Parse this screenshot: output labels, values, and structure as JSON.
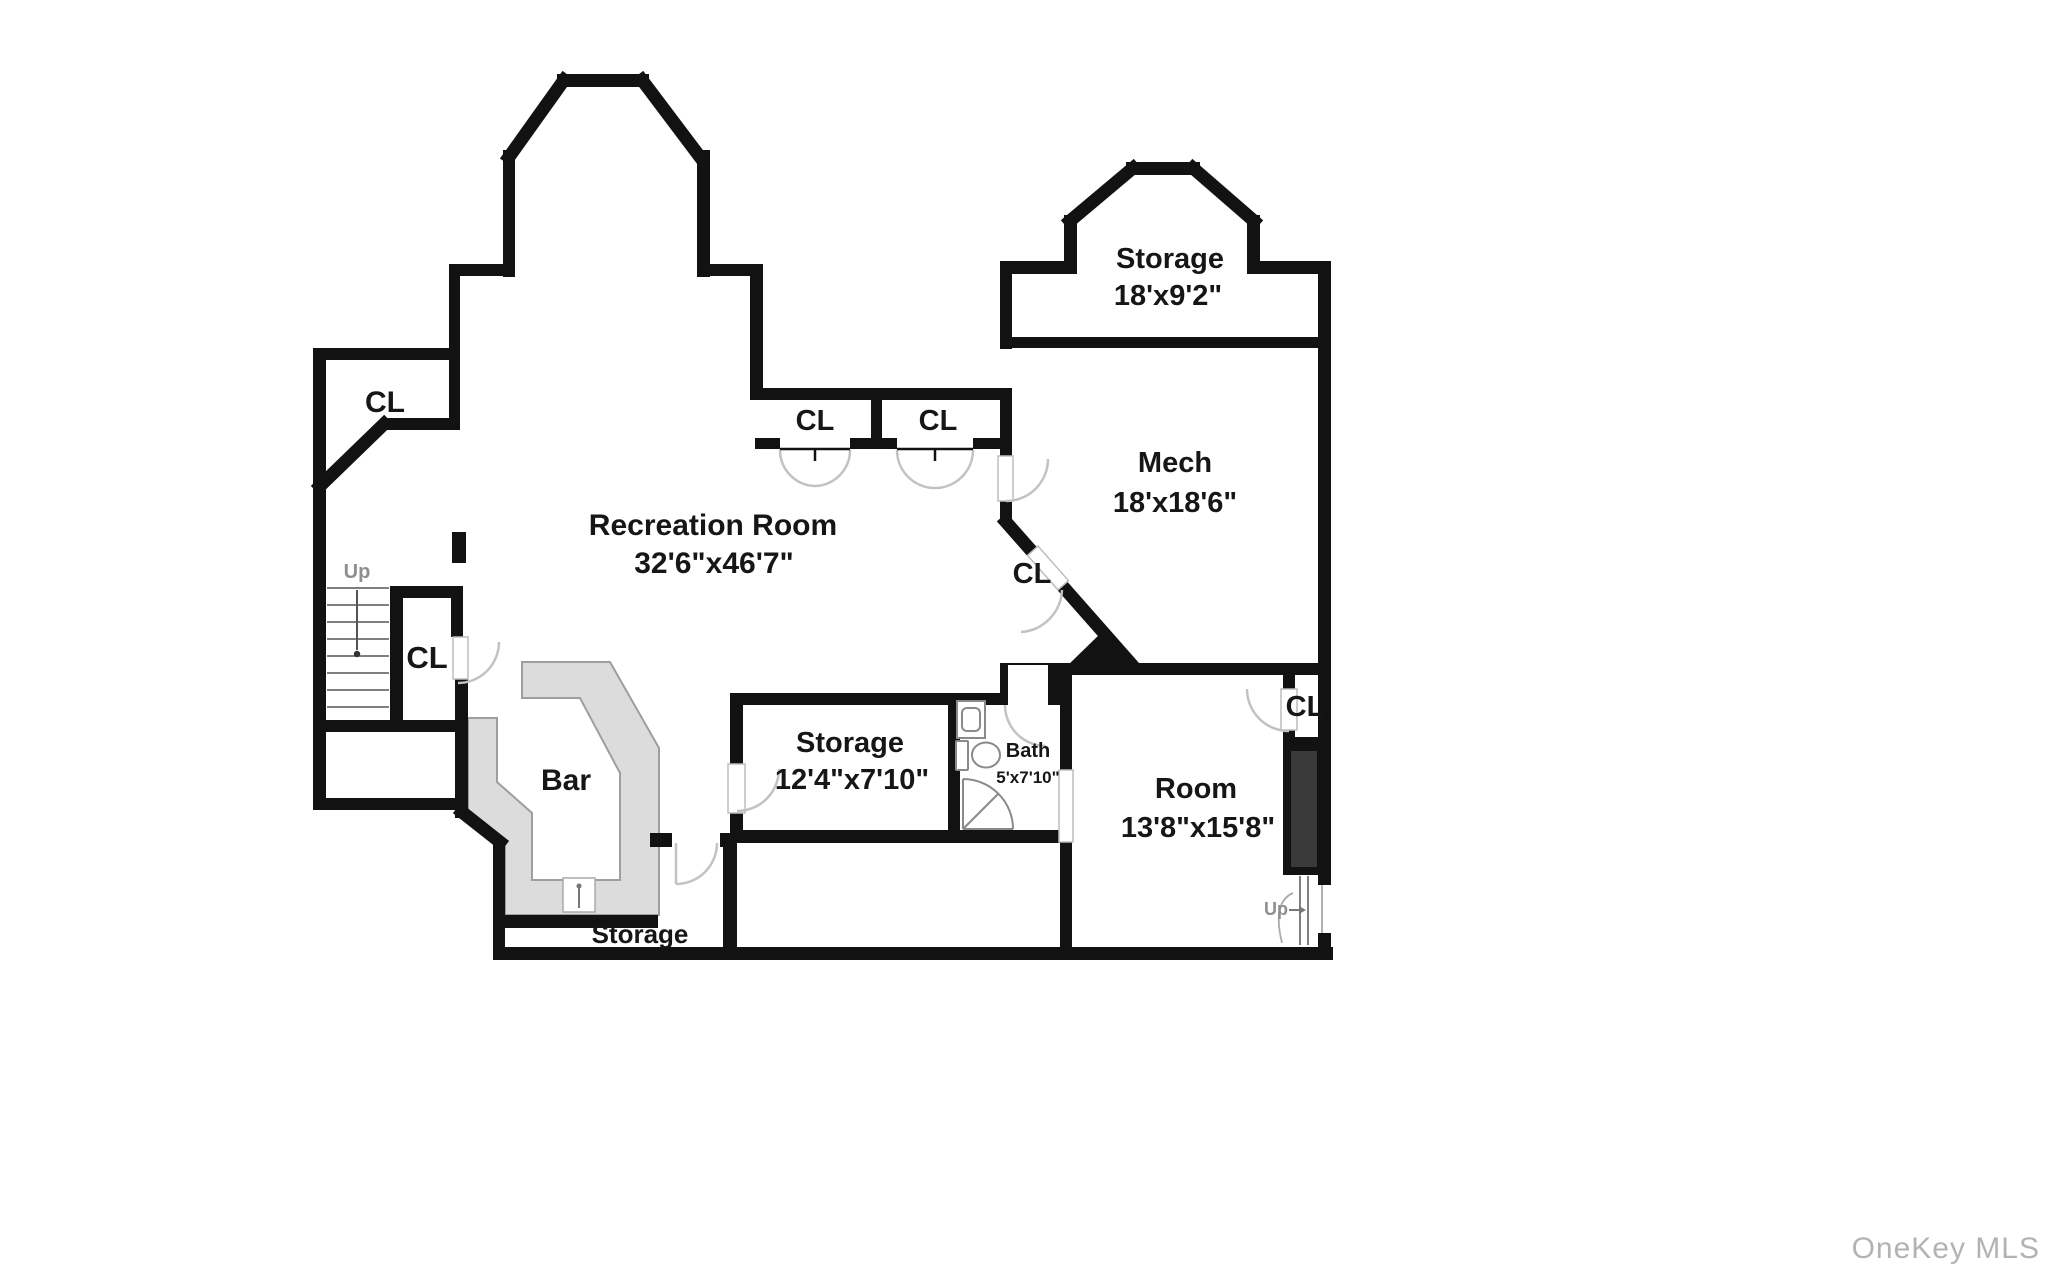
{
  "plan": {
    "title": "Basement floor plan",
    "rooms": [
      {
        "id": "recreation",
        "name": "Recreation Room",
        "dims": "32'6\"x46'7\""
      },
      {
        "id": "storage_upper",
        "name": "Storage",
        "dims": "18'x9'2\""
      },
      {
        "id": "mech",
        "name": "Mech",
        "dims": "18'x18'6\""
      },
      {
        "id": "storage_mid",
        "name": "Storage",
        "dims": "12'4\"x7'10\""
      },
      {
        "id": "bath",
        "name": "Bath",
        "dims": "5'x7'10\""
      },
      {
        "id": "room",
        "name": "Room",
        "dims": "13'8\"x15'8\""
      },
      {
        "id": "bar",
        "name": "Bar",
        "dims": ""
      },
      {
        "id": "storage_bottom",
        "name": "Storage",
        "dims": ""
      }
    ],
    "closet_label": "CL",
    "up_label": "Up",
    "watermark": "OneKey MLS",
    "colors": {
      "wall": "#121212",
      "bar_fill": "#dcdcdc",
      "bar_edge": "#9e9e9e",
      "door_arc": "#c2c2c2",
      "fixture": "#8a8a8a",
      "stair_line": "#555555",
      "up_text": "#8e8e8e",
      "watermark_text": "#b3b3b3",
      "inner_box": "#3a3a3a"
    }
  }
}
